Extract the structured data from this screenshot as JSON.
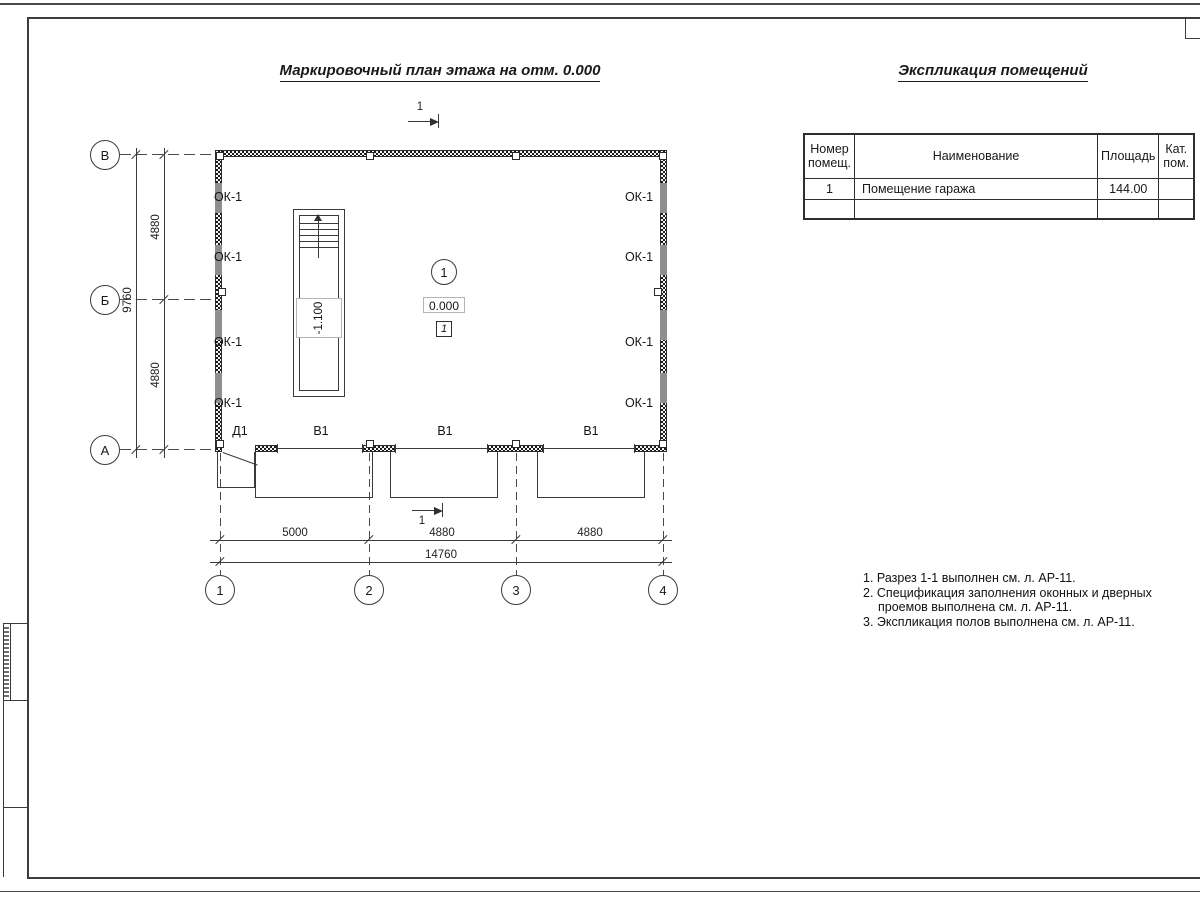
{
  "titles": {
    "plan": "Маркировочный план этажа на отм. 0.000",
    "explication": "Экспликация помещений"
  },
  "plan": {
    "window_mark": "ОК-1",
    "door_mark": "Д1",
    "gate_mark": "В1",
    "pit_level": "-1.100",
    "room_number": "1",
    "floor_level": "0.000",
    "floor_type": "1",
    "section_number": "1",
    "axes_rows": [
      "В",
      "Б",
      "А"
    ],
    "axes_cols": [
      "1",
      "2",
      "3",
      "4"
    ],
    "dims": {
      "v1": "4880",
      "v2": "4880",
      "v_total": "9760",
      "h1": "5000",
      "h2": "4880",
      "h3": "4880",
      "h_total": "14760"
    }
  },
  "explication_table": {
    "headers": [
      "Номер помещ.",
      "Наименование",
      "Площадь",
      "Кат. пом."
    ],
    "rows": [
      {
        "num": "1",
        "name": "Помещение гаража",
        "area": "144.00",
        "cat": ""
      }
    ]
  },
  "notes": {
    "l1": "1. Разрез 1-1 выполнен см. л. АР-11.",
    "l2": "2. Спецификация заполнения оконных и дверных",
    "l3": "проемов выполнена см. л. АР-11.",
    "l4": "3. Экспликация полов выполнена см. л. АР-11."
  },
  "colors": {
    "line": "#3a3a3a",
    "window_fill": "#8e8e8e",
    "wall_fill": "#1b1b1b"
  }
}
